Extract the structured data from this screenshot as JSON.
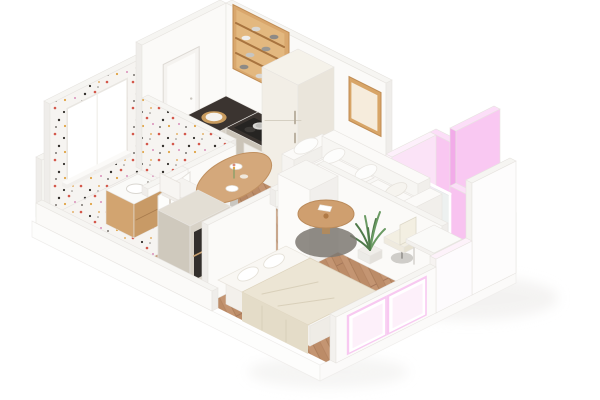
{
  "meta": {
    "title": "3D isometric cutaway rendering of a small one-bedroom apartment floor plan",
    "canvas_width": 600,
    "canvas_height": 400,
    "background": "#ffffff",
    "style": "isometric 3D architectural visualization, white walls, pink accent highlights"
  },
  "palette": {
    "background": "#ffffff",
    "wall_face_light": "#fbfaf8",
    "wall_face_shade": "#efedea",
    "wall_top": "#f6f5f2",
    "wall_edge": "#e7e4e0",
    "floor_wood": "#c49572",
    "floor_wood_seam": "#a97b58",
    "terrazzo_base": "#f6f4f1",
    "terrazzo_red": "#d4584b",
    "terrazzo_black": "#33302c",
    "terrazzo_ochre": "#df9f44",
    "terrazzo_pink": "#d98fb9",
    "accent_pink": "#f9c7f1",
    "accent_pink_pale": "#fcdef8",
    "accent_pink_deep": "#f2abe9",
    "counter_stone_dark": "#3b3430",
    "cabinet_beige": "#d7d1c6",
    "cabinet_beige_shade": "#cbc4b8",
    "wood_warm": "#d9a76d",
    "wood_warm_dark": "#c08c53",
    "appliance_cream": "#eae5db",
    "oven_black": "#201e1c",
    "sofa_white": "#f8f7f5",
    "bedding_cream": "#ece5d4",
    "glass_tint": "#e8f1f3",
    "plant_green": "#6a9a63",
    "plant_green_dark": "#4f7a4a",
    "rug_dark_gray": "#7d7872",
    "table_wood": "#d4a87b"
  },
  "rooms": [
    {
      "id": "bathroom",
      "label": "Bathroom",
      "finish": "white terrazzo tile with red, black and ochre speckles",
      "items": [
        "wood vanity with white sink",
        "wall window",
        "open door"
      ]
    },
    {
      "id": "kitchen",
      "label": "Kitchen",
      "items": [
        "L-shaped counter with dark stone top",
        "built-in oven",
        "cooktop with pot",
        "fridge freezer",
        "open wood shelving with cookware",
        "cutting board with plate",
        "herbs on counter"
      ]
    },
    {
      "id": "dining",
      "label": "Dining area",
      "items": [
        "oval wood dining table",
        "4 white upholstered chairs",
        "plates and flower sprig"
      ]
    },
    {
      "id": "living",
      "label": "Living room",
      "items": [
        "white three-seat sofa with cushions",
        "round wood coffee table with papers and vase",
        "dark gray rug",
        "framed wall art",
        "potted plant",
        "white desk",
        "office chair"
      ]
    },
    {
      "id": "balcony",
      "label": "Balcony nook",
      "items": [
        "pink accent walls",
        "glass partition"
      ]
    },
    {
      "id": "bedroom",
      "label": "Bedroom",
      "items": [
        "double bed with cream throw",
        "two pillows",
        "white wardrobe",
        "hall storage unit with open shelves",
        "front windows with pink reveals"
      ]
    }
  ]
}
